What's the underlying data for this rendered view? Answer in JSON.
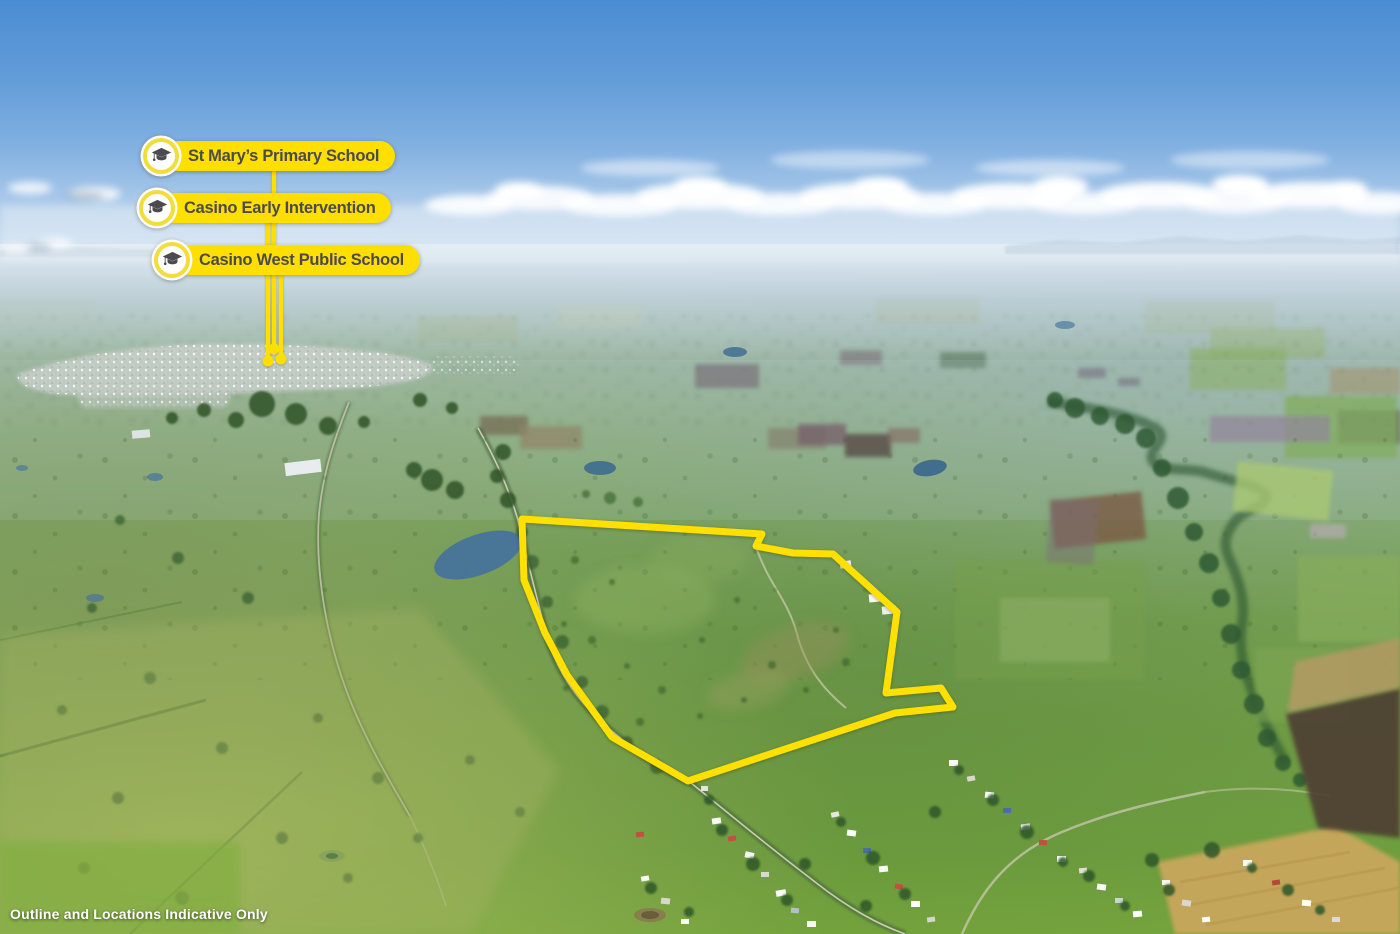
{
  "map": {
    "markers": [
      {
        "label": "St Mary’s Primary School",
        "icon": "graduation-cap"
      },
      {
        "label": "Casino Early Intervention",
        "icon": "graduation-cap"
      },
      {
        "label": "Casino West Public School",
        "icon": "graduation-cap"
      }
    ],
    "disclaimer": "Outline and Locations Indicative Only"
  },
  "colors": {
    "marker_yellow": "#FFDF00",
    "outline_yellow": "#FFE000",
    "badge_ring": "#F1DD3C",
    "marker_text": "#4B4A4F",
    "disclaimer_text": "#FFFFFF"
  }
}
